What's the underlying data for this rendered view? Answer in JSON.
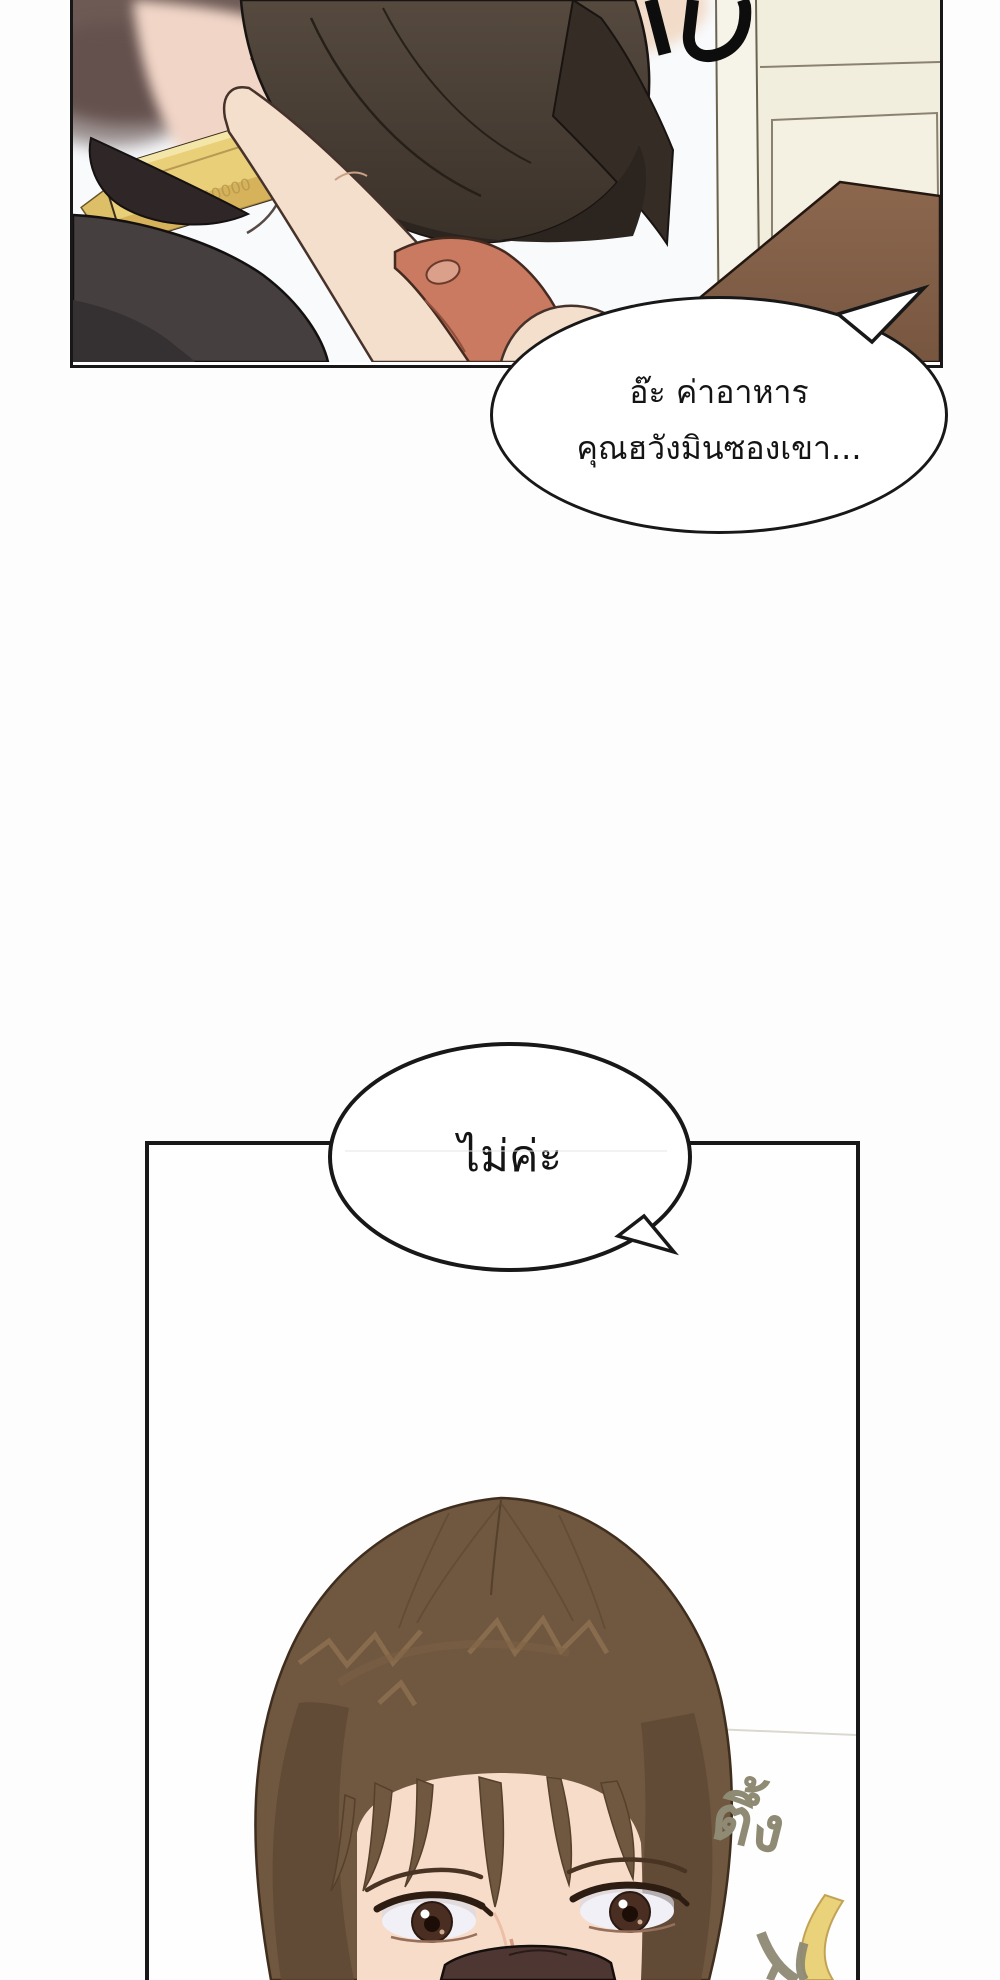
{
  "comic": {
    "bubble1": {
      "line1": "อ๊ะ ค่าอาหาร",
      "line2": "คุณฮวังมินซองเขา..."
    },
    "bubble2": {
      "line1": "ไม่ค่ะ"
    },
    "sfx": {
      "thud": "ตึ้ง"
    }
  },
  "colors": {
    "page_bg": "#fdfdfd",
    "panel_border": "#181818",
    "wall": "#f8fafc",
    "cabinet": "#f2eede",
    "table": "#8c674e",
    "wallet": "#4c4138",
    "banknote": "#e9cf78",
    "banknote_mark": "#a97f3e",
    "skin": "#f4dfcc",
    "skin_shadow": "#c97a61",
    "sleeve": "#45403f",
    "blurred_head": "#6d5a55",
    "hair": "#6f5740",
    "hair_highlight": "#8d7050",
    "face_skin": "#f8dcca",
    "eye_iris": "#4a2e21",
    "shirt": "#4e3733",
    "sfx_thud_color": "#8f8a74",
    "sfx_cropped_color": "#0d0d0d",
    "crescent": "#ead27b"
  }
}
